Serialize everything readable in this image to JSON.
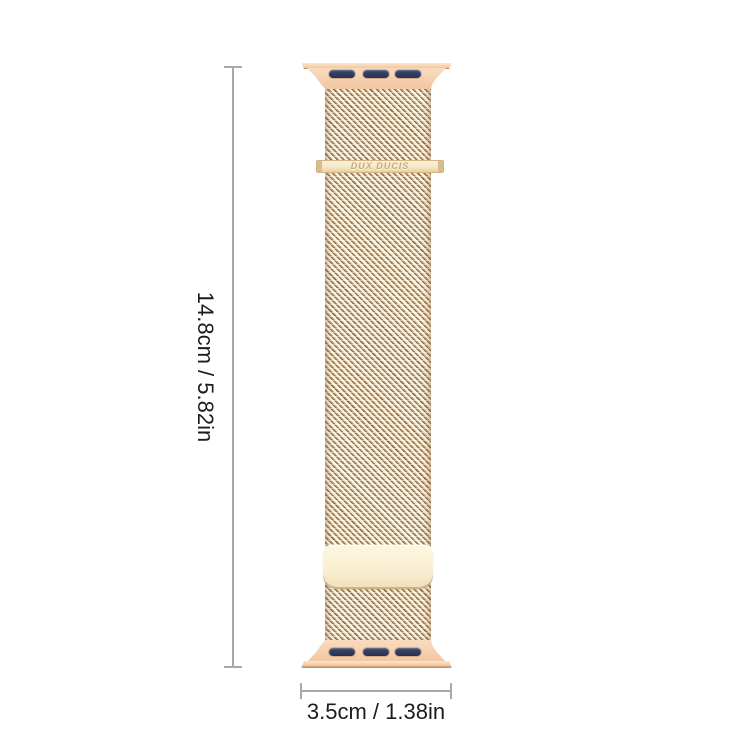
{
  "product": {
    "name": "milanese-loop-watch-band",
    "brand_text": "DUX DUCIS",
    "slot_count_per_lug": 3
  },
  "dimensions": {
    "height_label": "14.8cm / 5.82in",
    "width_label": "3.5cm / 1.38in"
  },
  "colors": {
    "background": "#ffffff",
    "band_gold": "#f6cfae",
    "mesh_base": "#f1e3c6",
    "mesh_strand_dark": "#8b6a46",
    "mesh_strand_light": "#fffdf4",
    "lug_slot_navy": "#2d3a59",
    "clasp_cream": "#f8eed0",
    "brand_text_gold": "#c6a976",
    "dimension_line_gray": "#a8a8a8",
    "dimension_text": "#1c1c1c"
  }
}
